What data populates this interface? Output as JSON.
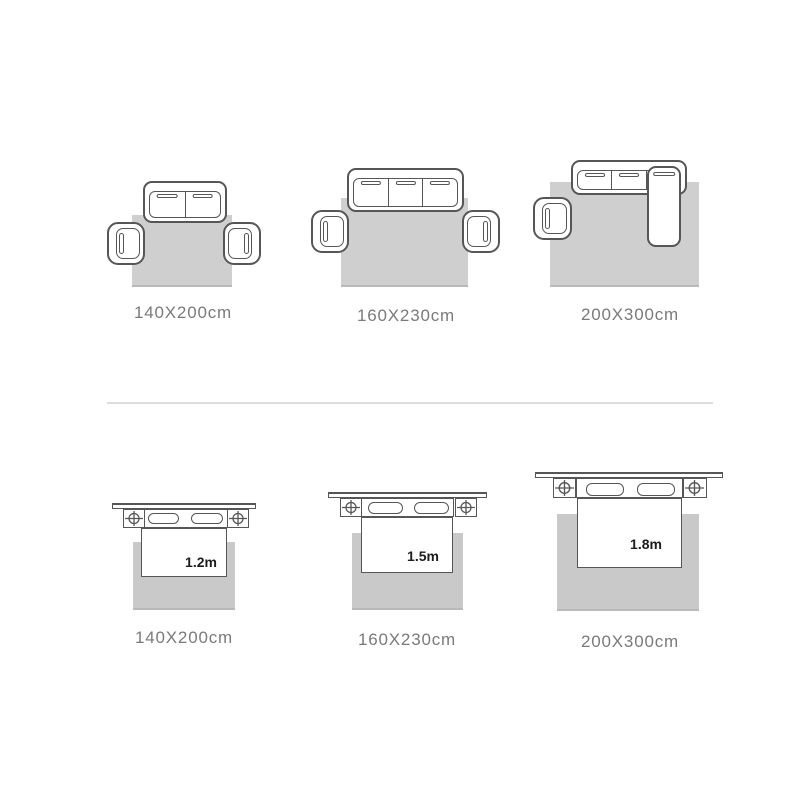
{
  "colors": {
    "background": "#ffffff",
    "rug_living": "#cfcfcf",
    "rug_bedroom": "#c9c9c9",
    "furniture_outline": "#565656",
    "label_text": "#7a7a7a",
    "bed_size_text": "#1d1d1d",
    "divider": "#dcdcdc"
  },
  "rows": [
    {
      "id": "living-room-rug-sizes",
      "scenes": [
        {
          "type": "two-seat-sofa-with-two-armchairs",
          "label": "140X200cm"
        },
        {
          "type": "three-seat-sofa-with-two-armchairs",
          "label": "160X230cm"
        },
        {
          "type": "sectional-sofa-with-one-armchair",
          "label": "200X300cm"
        }
      ]
    },
    {
      "id": "bedroom-rug-sizes",
      "scenes": [
        {
          "type": "bed-with-nightstands",
          "bed_width": "1.2m",
          "label": "140X200cm"
        },
        {
          "type": "bed-with-nightstands",
          "bed_width": "1.5m",
          "label": "160X230cm"
        },
        {
          "type": "bed-with-nightstands",
          "bed_width": "1.8m",
          "label": "200X300cm"
        }
      ]
    }
  ]
}
